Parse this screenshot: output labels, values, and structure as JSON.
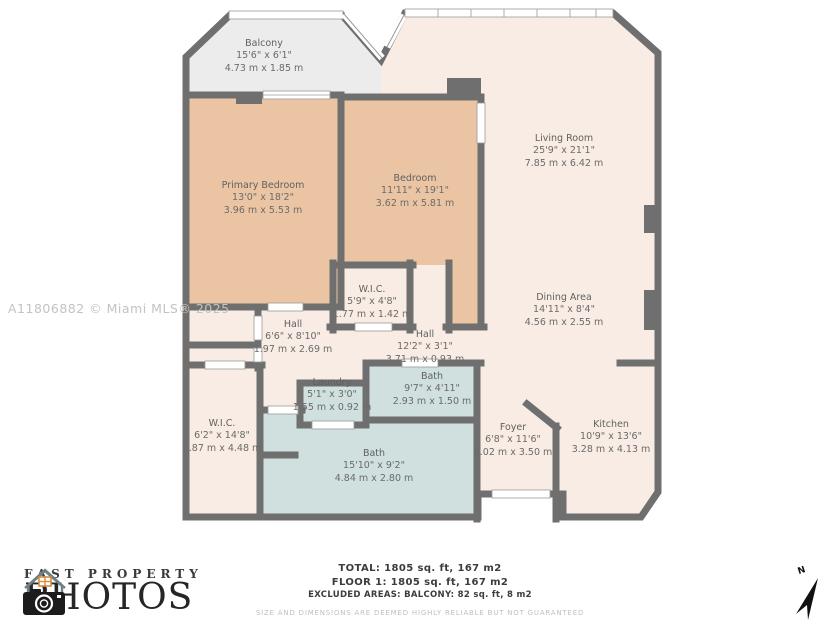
{
  "watermark": "A11806882 © Miami MLS® 2025",
  "rooms": {
    "balcony": {
      "name": "Balcony",
      "ft": "15'6\" x 6'1\"",
      "m": "4.73 m x 1.85 m"
    },
    "primary_bedroom": {
      "name": "Primary Bedroom",
      "ft": "13'0\" x 18'2\"",
      "m": "3.96 m x 5.53 m"
    },
    "bedroom": {
      "name": "Bedroom",
      "ft": "11'11\" x 19'1\"",
      "m": "3.62 m x 5.81 m"
    },
    "living_room": {
      "name": "Living Room",
      "ft": "25'9\" x 21'1\"",
      "m": "7.85 m x 6.42 m"
    },
    "dining_area": {
      "name": "Dining Area",
      "ft": "14'11\" x 8'4\"",
      "m": "4.56 m x 2.55 m"
    },
    "wic_middle": {
      "name": "W.I.C.",
      "ft": "5'9\" x 4'8\"",
      "m": "1.77 m x 1.42 m"
    },
    "hall_left": {
      "name": "Hall",
      "ft": "6'6\" x 8'10\"",
      "m": "1.97 m x 2.69 m"
    },
    "hall_right": {
      "name": "Hall",
      "ft": "12'2\" x 3'1\"",
      "m": "3.71 m x 0.93 m"
    },
    "laundry": {
      "name": "Laundry",
      "ft": "5'1\" x 3'0\"",
      "m": "1.55 m x 0.92 m"
    },
    "bath_small": {
      "name": "Bath",
      "ft": "9'7\" x 4'11\"",
      "m": "2.93 m x 1.50 m"
    },
    "wic_bottom": {
      "name": "W.I.C.",
      "ft": "6'2\" x 14'8\"",
      "m": "1.87 m x 4.48 m"
    },
    "bath_big": {
      "name": "Bath",
      "ft": "15'10\" x 9'2\"",
      "m": "4.84 m x 2.80 m"
    },
    "foyer": {
      "name": "Foyer",
      "ft": "6'8\" x 11'6\"",
      "m": "2.02 m x 3.50 m"
    },
    "kitchen": {
      "name": "Kitchen",
      "ft": "10'9\" x 13'6\"",
      "m": "3.28 m x 4.13 m"
    }
  },
  "summary": {
    "total": "TOTAL: 1805 sq. ft, 167 m2",
    "floor1": "FLOOR 1: 1805 sq. ft, 167 m2",
    "excluded": "EXCLUDED AREAS: BALCONY: 82 sq. ft, 8 m2",
    "disclaimer": "SIZE AND DIMENSIONS ARE DEEMED HIGHLY RELIABLE BUT NOT GUARANTEED"
  },
  "logo": {
    "top": "FAST PROPERTY",
    "bottom": "PHOTOS"
  },
  "compass": {
    "label": "N"
  },
  "colors": {
    "wall": "#6f6f6f",
    "bedroom_fill": "#ebc5a3",
    "floor_fill": "#f8ece4",
    "wet_room_fill": "#cfe0df",
    "balcony_fill": "#ececec"
  }
}
